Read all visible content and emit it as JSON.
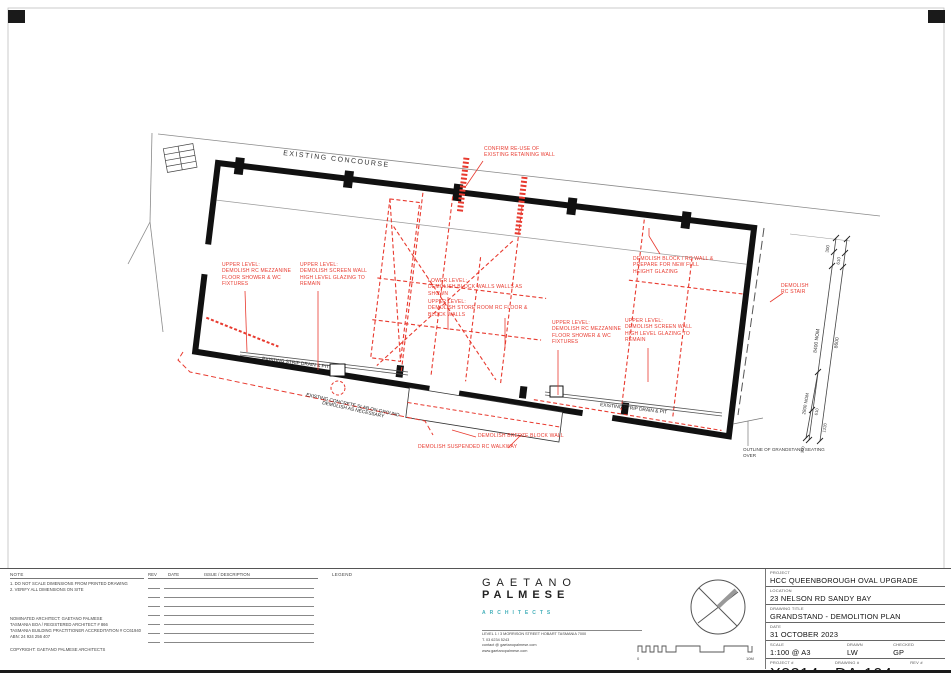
{
  "plan": {
    "concourse_label": "EXISTING CONCOURSE",
    "notes_red": {
      "confirm": "CONFIRM RE-USE OF\nEXISTING RETAINING WALL",
      "upper_mezz_left": "UPPER LEVEL:\nDEMOLISH RC MEZZANINE\nFLOOR SHOWER & WC\nFIXTURES",
      "upper_screen_left": "UPPER LEVEL:\nDEMOLISH SCREEN WALL\nHIGH LEVEL GLAZING TO\nREMAIN",
      "lower_block": "LOWER LEVEL:\nDEMOLISH BLOCK WALLS WALLS AS\nSHOWN",
      "upper_store": "UPPER LEVEL:\nDEMOLISH STORE ROOM RC FLOOR &\nBLOCK WALLS",
      "upper_mezz_right": "UPPER LEVEL:\nDEMOLISH RC MEZZANINE\nFLOOR SHOWER & WC\nFIXTURES",
      "upper_screen_right": "UPPER LEVEL:\nDEMOLISH SCREEN WALL\nHIGH LEVEL GLAZING TO\nREMAIN",
      "block_rc_wall": "DEMOLISH BLOCK / RC WALL &\nPREPARE FOR NEW FULL\nHEIGHT GLAZING",
      "rc_stair": "DEMOLISH\nRC STAIR",
      "breeze_wall": "DEMOLISH BREEZE BLOCK WALL",
      "walkway": "DEMOLISH SUSPENDED RC WALKWAY"
    },
    "notes_black": {
      "strip_drain_left": "EXISTING STRIP DRAIN & PIT",
      "strip_drain_right": "EXISTING STRIP DRAIN & PIT",
      "slab_line1": "EXISTING CONCRETE SLAB ON GROUND",
      "slab_line2": "DEMOLISH AS NECESSARY",
      "seating_outline": "OUTLINE OF GRANDSTAND SEATING\nOVER"
    },
    "dimensions": {
      "d300_top": "300",
      "d610_top": "610",
      "d8400": "8400 NOM",
      "d8600": "8600",
      "d2800": "2800 NOM",
      "d610_bot": "610",
      "d1220": "1220",
      "d300_bot": "300"
    }
  },
  "notes_panel": {
    "title": "NOTE",
    "note1": "1. DO NOT SCALE DIMENSIONS FROM PRINTED DRAWING",
    "note2": "2. VERIFY ALL DIMENSIONS ON SITE",
    "architect_line1": "NOMINATED ARCHITECT: GAETANO PALMESE",
    "architect_line2": "TASMANIA BOA / REGISTERED ARCHITECT # 866",
    "architect_line3": "TASMANIA BUILDING PRACTITIONER ACCREDITATION # CC61940",
    "architect_line4": "ABN: 24 924 256 407",
    "copyright": "COPYRIGHT: GAETANO PALMESE ARCHITECTS"
  },
  "rev_table": {
    "rev": "REV",
    "date": "DATE",
    "issue": "ISSUE / DESCRIPTION"
  },
  "legend": {
    "title": "LEGEND"
  },
  "architect_block": {
    "name_line1": "GAETANO",
    "name_line2": "PALMESE",
    "subtitle": "ARCHITECTS",
    "address": "LEVEL 1 / 3 MORRISON STREET    HOBART    TASMANIA    7000",
    "phone": "T.   03 6234 5243",
    "email": "contact @ gaetanopalmese.com",
    "web": "www.gaetanopalmese.com"
  },
  "scalebar": {
    "start": "0",
    "end": "10M"
  },
  "titleblock": {
    "project_label": "PROJECT",
    "project": "HCC QUEENBOROUGH OVAL UPGRADE",
    "location_label": "LOCATION",
    "location": "23 NELSON RD SANDY BAY",
    "title_label": "DRAWING TITLE",
    "title": "GRANDSTAND - DEMOLITION PLAN",
    "date_label": "DATE",
    "date": "31 OCTOBER 2023",
    "scale_label": "SCALE",
    "scale": "1:100 @ A3",
    "drawn_label": "DRAWN",
    "drawn": "LW",
    "checked_label": "CHECKED",
    "checked": "GP",
    "project_no_label": "PROJECT #",
    "project_no": "X2214",
    "drawing_no_label": "DRAWING #",
    "drawing_no": "DA-104",
    "rev_label": "REV #"
  },
  "colors": {
    "demolition_red": "#e83a2f",
    "architect_teal": "#45b0ba"
  }
}
